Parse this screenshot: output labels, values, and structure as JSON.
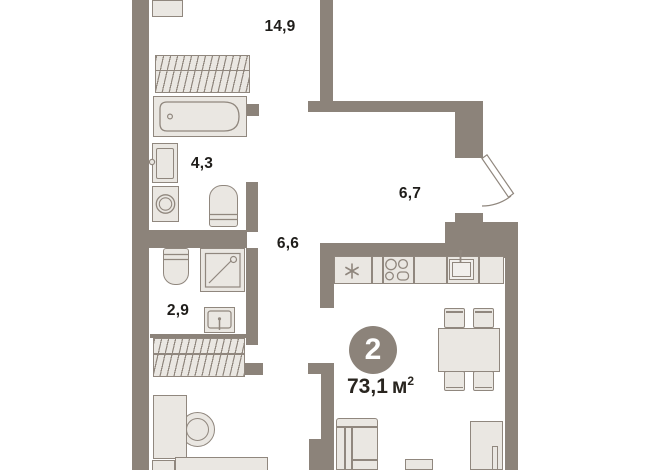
{
  "floor_plan": {
    "rooms_count_badge": "2",
    "total_area": {
      "value": "73,1",
      "unit": "м",
      "superscript": "2"
    },
    "room_labels": {
      "living_room": "14,9",
      "bathroom": "4,3",
      "hallway": "6,7",
      "corridor": "6,6",
      "wc": "2,9"
    },
    "icons": {
      "fridge": "snowflake-asterisk",
      "entrance": "door-swing-arc"
    },
    "colors": {
      "wall": "#8c837a",
      "fixture_fill": "#eae7e2",
      "fixture_stroke": "#90877e",
      "label_text": "#1f1d1a",
      "badge_fill": "#8c837a",
      "badge_text": "#ffffff",
      "background": "#ffffff"
    }
  }
}
